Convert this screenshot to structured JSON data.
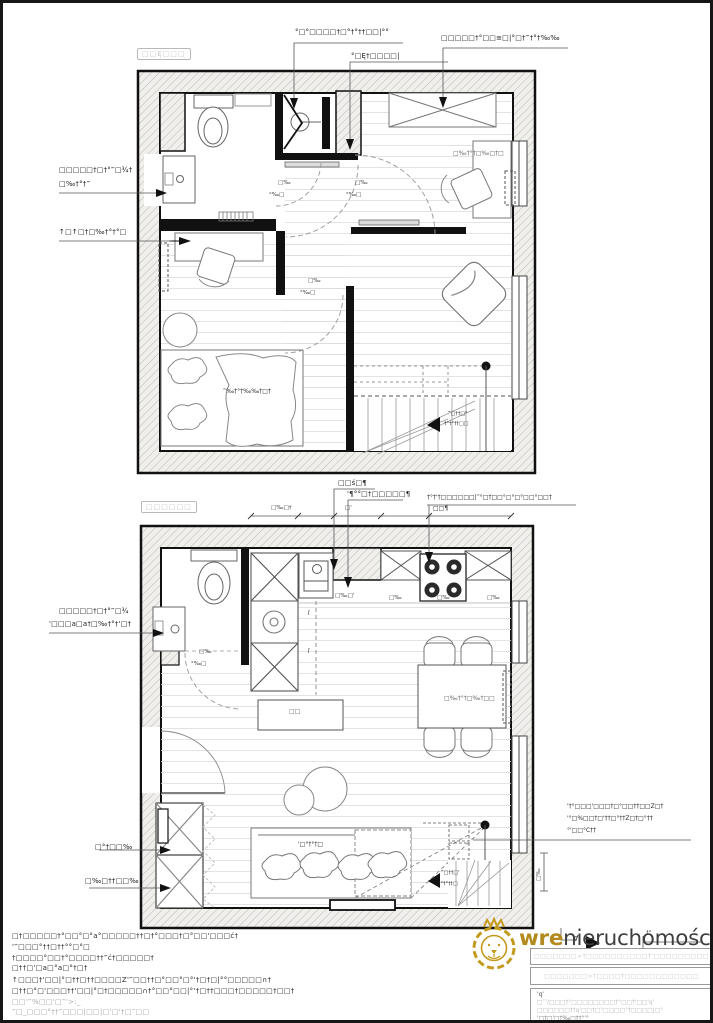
{
  "page": {
    "background": "#ffffff",
    "border_color": "#161616",
    "hatch_color": "#b8b8b8",
    "wall_color": "#111111",
    "accent_gold": "#c49a1e"
  },
  "upper_plan": {
    "room_tag": "□□Ę□□□",
    "labels": {
      "top_shower": "°□°□□□□†□°†°††□□|°°",
      "top_door": "°□Ę†□□□□|",
      "top_wardrobe": "□□□□□†°□□≡□|°□†‴†°†‰‰",
      "left_sink_1": "□□□□□†□†°‴□¾†",
      "left_sink_2": "□‰†°†‴",
      "left_desk": "↑□↑□†□‰†°†°□",
      "window_note": "□‰†°†□‰□†□",
      "bed_note": "‴‰†°†‰‰†□†",
      "stairs_1": "‴□††□°",
      "stairs_2": "†°†°††□□"
    },
    "dims": {
      "a1": "□‰",
      "a2": "°‰□",
      "b1": "□‰",
      "b2": "°‰□",
      "c1": "□‰",
      "c2": "°‰□"
    }
  },
  "lower_plan": {
    "room_tag": "□□□□□□",
    "labels": {
      "kitchen_sink": "□□ś□¶",
      "kitchen_tall": "'¶°°□†□□□□□¶",
      "kitchen_hob": "†°†'†□□□□□□|‴°□†□□°□°□°□□°□□†",
      "kitchen_hob_2": "□□¶",
      "wc_sink_1": "□□□□□†□†°‴□¾",
      "wc_sink_2": "'□□□a□a†□‰†°†'□†",
      "wardrobe_a": "□°†□□‰",
      "wardrobe_b": "□‰□††□□‰",
      "sofa_note": "'□°†°†□",
      "island_note": "□□",
      "table_note": "□‰†°†□‰†□□",
      "stairs_1": "‴□††□'",
      "stairs_2": "†°†°††□",
      "right_note_1": "'†°□□□'□□□†□°□□††□□Z□†",
      "right_note_2": "'°□%□□†□'††□°††Z□†□°††",
      "right_note_3": "°'□□°C††",
      "marker": "∀",
      "bottom_dim": "†°",
      "vertical_dim": "□‰",
      "elec_1": "ʃ",
      "elec_2": "ʃ"
    },
    "dims": {
      "top_a": "□‰□†",
      "top_b": "□'",
      "wc_1": "□‰",
      "wc_2": "°‰□",
      "counter_1": "□‰□'",
      "counter_2": "□‰",
      "counter_3": "□‰",
      "counter_4": "□‰"
    }
  },
  "footer": {
    "notes": [
      "□†□□□□□†°□□°□°a°□□□□□††□†°□□□†□°□□'□□□ć†",
      "'‴□□□°††□††°°□°□",
      "†□□□□°□□†°□□□□††‴ć†□□□□□†",
      "□††□'□a□°a□°†□†",
      "↑□□□†'□□|°□††□††□□□□Z'‴□□††□°□□°□°'†□†□|°°□□□□□∩†",
      "□††□°□'□□□††'□□|°□†□□□□□∩†°□□°□□|°'†□††□□□†□□□□□†□□†",
      "□□'‴%□□'□‴'>:_",
      "‴□_□□□°††‴□□□|□□|□'□'†□‴□□"
    ]
  },
  "logo": {
    "bold": "wre",
    "rest": "nieruchomości"
  },
  "title_block": {
    "row1": "□□□□□□□>†□□□□□□□□□□†'□□□□□□□□□",
    "row2": "□□□□□□□>†□□□□†□□□□□□□□□□□□",
    "row3_lines": [
      "'q'",
      "□‴'/□□□†°□□□□□□□□†°□□†'□□'q'",
      "□□□□□□††q'□□†□°□□□□°†□□□□|□°",
      "'□†□'□†‰□††°'°"
    ]
  }
}
